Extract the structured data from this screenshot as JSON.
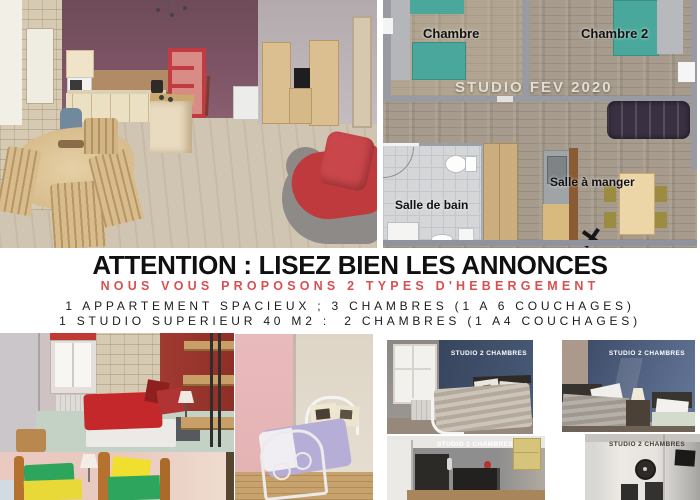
{
  "colors": {
    "accent_red": "#d95050",
    "headline_black": "#101010",
    "floorplan_teal": "#49a89b",
    "studio_navy": "#3d4a61"
  },
  "floorplan": {
    "room1_label": "Chambre",
    "room2_label": "Chambre 2",
    "studio_label": "STUDIO FEV 2020",
    "bathroom_label": "Salle de bain",
    "dining_label": "Salle à manger"
  },
  "announcement": {
    "headline": "ATTENTION : LISEZ BIEN LES ANNONCES",
    "subheadline": "NOUS VOUS PROPOSONS 2 TYPES D'HEBERGEMENT",
    "line1": "1 APPARTEMENT SPACIEUX ; 3 CHAMBRES (1 A 6 COUCHAGES)",
    "line2": "1 STUDIO SUPERIEUR 40 M2 :  2 CHAMBRES (1 A4 COUCHAGES)"
  },
  "bottom_photos": {
    "studio_label_1": "STUDIO 2 CHAMBRES",
    "studio_label_2": "STUDIO 2 CHAMBRES",
    "studio_label_3": "STUDIO 2 CHAMBRES",
    "studio_label_4": "STUDIO 2 CHAMBRES"
  }
}
